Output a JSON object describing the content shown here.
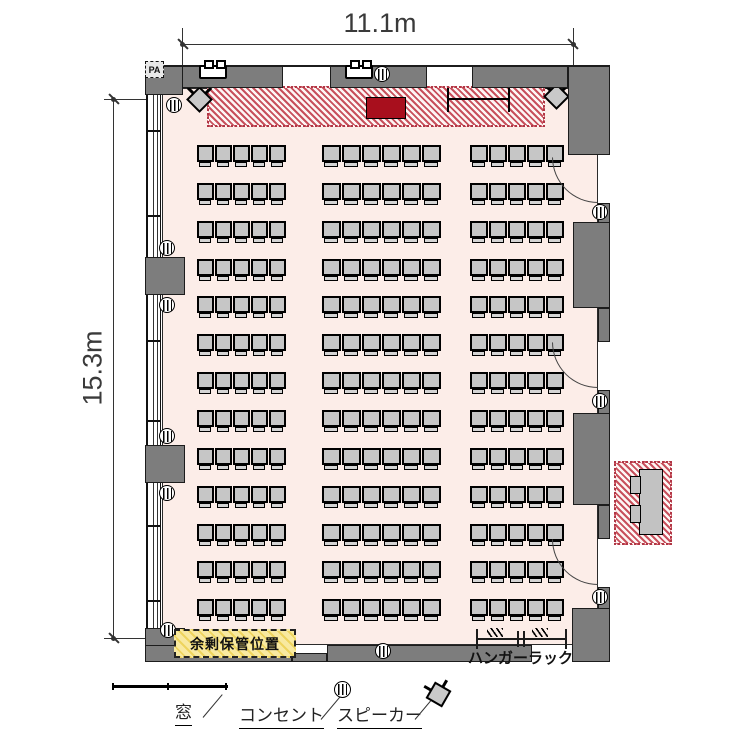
{
  "page": {
    "type": "seminar-room-floor-plan"
  },
  "dimensions": {
    "width_label": "11.1m",
    "height_label": "15.3m"
  },
  "stage": {
    "pa_label": "PA"
  },
  "annotations": {
    "storage_label": "余剰保管位置",
    "hanger_rack_label": "ハンガーラック"
  },
  "legend": {
    "window_label": "窓",
    "outlet_label": "コンセント",
    "speaker_label": "スピーカー"
  },
  "seating": {
    "rows": 13,
    "blocks_per_row": [
      5,
      6,
      5
    ],
    "total_seats": 208
  },
  "colors": {
    "floor": "#fcede8",
    "wall": "#7d7d7d",
    "chair": "#c6c6c6",
    "stage_stripe": "#c8505c",
    "podium": "#a80f1d",
    "storage_fill": "#f8e9a0"
  }
}
